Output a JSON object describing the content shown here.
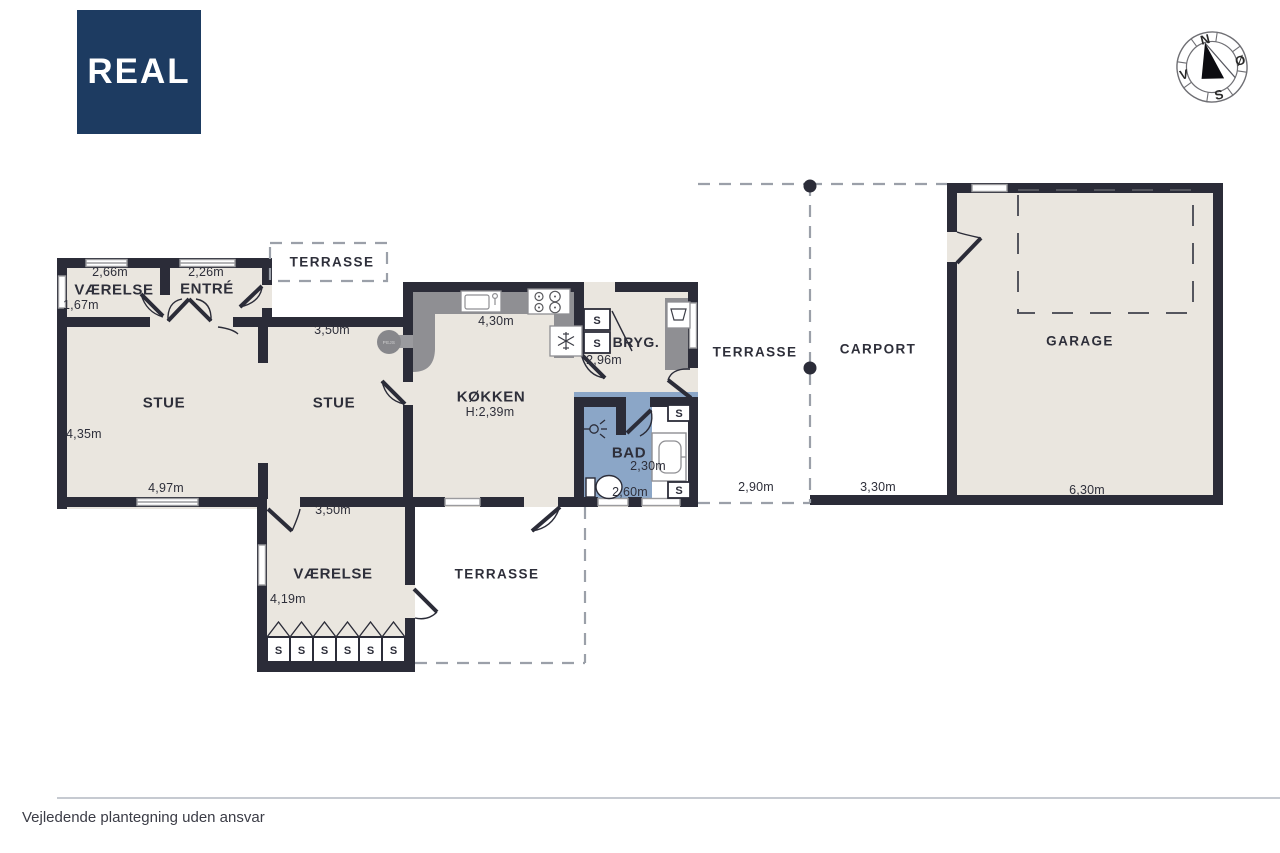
{
  "brand": {
    "logo_text": "REAL"
  },
  "compass": {
    "north": "N",
    "east": "Ø",
    "south": "S",
    "west": "V"
  },
  "footer": {
    "disclaimer": "Vejledende plantegning uden ansvar"
  },
  "colors": {
    "wall": "#2b2c38",
    "floor": "#eae6df",
    "bath_floor": "#8ba6c7",
    "counter": "#8f8f93",
    "logo_bg": "#1d3b61",
    "dashed": "#9ba0a9"
  },
  "plan": {
    "closet_label": "S",
    "fireplace_label": "PEJS",
    "rooms": {
      "vaerelse_nw": {
        "label": "VÆRELSE",
        "width": "2,66m",
        "depth": "1,67m"
      },
      "entre": {
        "label": "ENTRÉ",
        "width": "2,26m"
      },
      "terrasse_top": {
        "label": "TERRASSE"
      },
      "stue_left": {
        "label": "STUE",
        "width": "4,97m",
        "depth": "4,35m"
      },
      "stue_right": {
        "label": "STUE",
        "width": "3,50m"
      },
      "koekken": {
        "label": "KØKKEN",
        "ceiling_height": "H:2,39m",
        "width": "4,30m"
      },
      "bryg": {
        "label": "BRYG.",
        "width": "2,96m"
      },
      "bad": {
        "label": "BAD",
        "width": "2,60m",
        "depth": "2,30m"
      },
      "terrasse_mid": {
        "label": "TERRASSE",
        "width": "2,90m"
      },
      "carport": {
        "label": "CARPORT",
        "width": "3,30m"
      },
      "garage": {
        "label": "GARAGE",
        "width": "6,30m"
      },
      "vaerelse_s": {
        "label": "VÆRELSE",
        "width": "3,50m",
        "depth": "4,19m"
      },
      "terrasse_s": {
        "label": "TERRASSE"
      }
    }
  }
}
